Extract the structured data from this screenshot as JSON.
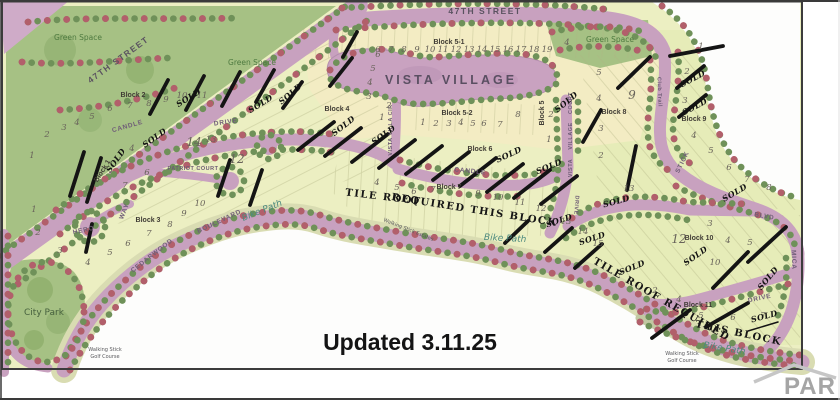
{
  "map": {
    "title": "VISTA VILLAGE",
    "sold": "SOLD",
    "updated": "Updated 3.11.25",
    "watermark": "PAR",
    "tile_roof_a1": "TILE ROOF",
    "tile_roof_a2": "REQUIRED THIS BLOCK",
    "tile_roof_b1": "TILE ROOF REQUIRED",
    "tile_roof_b2": "THIS BLOCK",
    "streets": {
      "st47": "47TH STREET",
      "candle": "CANDLE",
      "drive": "DRIVE",
      "patriot_court": "PATRIOT COURT",
      "hero": "HERO",
      "way": "WAY",
      "cedarwood": "CEDARWOOD",
      "boulevard": "BOULEVARD",
      "vista_villa_cir": "VISTA VILLA CIR",
      "court": "COURT",
      "village": "VILLAGE",
      "vista": "VISTA",
      "club_trail": "Club Trail",
      "stick": "STICK",
      "blvd": "BLVD",
      "mica": "MICA",
      "bike_path": "Bike Path"
    },
    "areas": {
      "green_space": "Green Space",
      "city_park": "City Park",
      "walking_stick": "Walking Stick",
      "golf_course": "Golf Course",
      "estates": "Walking Stick Estates"
    },
    "blocks": {
      "b1": {
        "label": "Block 1"
      },
      "b2": {
        "label": "Block 2",
        "lots": [
          "1",
          "2",
          "3",
          "4",
          "5",
          "6",
          "7",
          "8",
          "9",
          "10",
          "11"
        ],
        "court_lots": [
          "4",
          "6",
          "7",
          "12",
          "13",
          "14"
        ]
      },
      "b3": {
        "label": "Block 3",
        "lots": [
          "1",
          "2",
          "3",
          "4",
          "5",
          "6",
          "7",
          "8",
          "9",
          "10"
        ]
      },
      "b4": {
        "label": "Block 4",
        "lots": [
          "1",
          "2",
          "3",
          "4",
          "5",
          "6"
        ]
      },
      "b51": {
        "label": "Block 5-1",
        "lots": [
          "6",
          "7",
          "8",
          "9",
          "10",
          "11",
          "12",
          "13",
          "14",
          "15",
          "16",
          "17",
          "18",
          "19"
        ]
      },
      "b52": {
        "label": "Block 5-2",
        "lots": [
          "1",
          "2",
          "3",
          "4",
          "5",
          "6",
          "7",
          "8"
        ]
      },
      "b5": {
        "label": "Block 5",
        "lots": [
          "1",
          "2"
        ]
      },
      "b6": {
        "label": "Block 6",
        "lots": [
          "13",
          "14",
          "15"
        ]
      },
      "b7": {
        "label": "Block 7",
        "lots": [
          "4",
          "5",
          "6",
          "7",
          "9",
          "10",
          "11",
          "12"
        ]
      },
      "b8": {
        "label": "Block 8",
        "lots": [
          "2",
          "3",
          "4",
          "5",
          "9",
          "13",
          "4"
        ]
      },
      "b9": {
        "label": "Block 9",
        "lots": [
          "1",
          "2",
          "3",
          "4",
          "5",
          "6",
          "7",
          "8"
        ]
      },
      "b10": {
        "label": "Block 10",
        "lots": [
          "3",
          "4",
          "5",
          "10",
          "12"
        ]
      },
      "b11": {
        "label": "Block 11",
        "lots": [
          "2",
          "4",
          "5",
          "6",
          "7"
        ]
      }
    },
    "colors": {
      "road": "#c8a1bf",
      "land": "#ecefc2",
      "cream_lots": "#f3ecc3",
      "green_space": "#a6c184",
      "tree_green": "#6f9159",
      "tree_red": "#b25f6b",
      "sold_mark": "#141414",
      "bike_path_text": "#4d8a7f"
    }
  }
}
